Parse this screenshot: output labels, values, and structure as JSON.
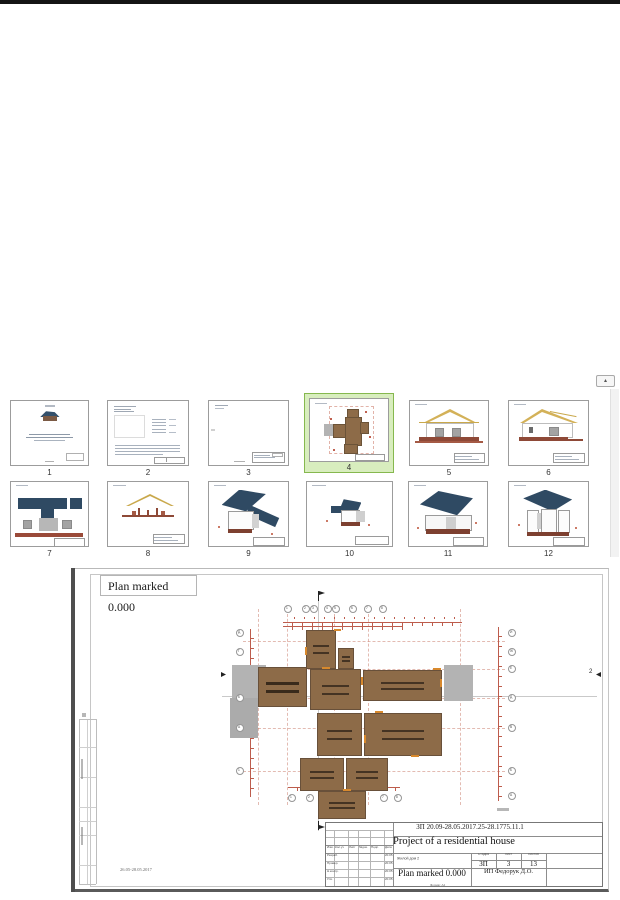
{
  "top_bar_color": "#141414",
  "thumbnails": {
    "items": [
      {
        "label": "1",
        "name": "title-page"
      },
      {
        "label": "2",
        "name": "general-notes-sheet"
      },
      {
        "label": "3",
        "name": "blank-sheet"
      },
      {
        "label": "4",
        "name": "floor-plan-sheet",
        "selected": true
      },
      {
        "label": "5",
        "name": "elevation-front"
      },
      {
        "label": "6",
        "name": "elevation-rear"
      },
      {
        "label": "7",
        "name": "elevation-side"
      },
      {
        "label": "8",
        "name": "section"
      },
      {
        "label": "9",
        "name": "3d-view-1"
      },
      {
        "label": "10",
        "name": "3d-view-2"
      },
      {
        "label": "11",
        "name": "3d-view-3"
      },
      {
        "label": "12",
        "name": "3d-view-4"
      }
    ],
    "selected_bg": "#d8edbe",
    "selected_border": "#86b84e"
  },
  "scrollbar": {
    "up_glyph": "▴"
  },
  "preview": {
    "plan_label": "Plan marked 0.000",
    "sheet_note": "26.05-28.05.2017",
    "section_marker": "2",
    "axes_top": [
      "1",
      "2",
      "3",
      "4",
      "5",
      "6",
      "7",
      "8"
    ],
    "axes_left": [
      "Д",
      "Г",
      "Б",
      "А",
      "1"
    ],
    "axes_right": [
      "И",
      "Ж",
      "Е",
      "Д",
      "В",
      "Б",
      "А"
    ],
    "axes_bottom": [
      "1",
      "2",
      "7",
      "8"
    ],
    "title_block": {
      "code": "ЗП 20.09-28.05.2017.25-28.1775.11.1",
      "project_title": "Project of a residential house",
      "object_name": "Жилой дом 2",
      "stage_label": "Стадия",
      "sheet_label": "Лист",
      "sheets_label": "Листов",
      "stage": "ЗП",
      "sheet": "3",
      "sheets": "13",
      "drawing_title": "Plan marked 0.000",
      "author": "ИП Федорук Д.О.",
      "columns": [
        "Изм.",
        "Кол.уч",
        "Лист",
        "№док.",
        "Подп.",
        "Дата"
      ],
      "rows": [
        {
          "label": "Разраб.",
          "date": "20.05"
        },
        {
          "label": "Провер.",
          "date": "20.05"
        },
        {
          "label": "Н.контр.",
          "date": "20.05"
        },
        {
          "label": "Утв.",
          "date": "20.05"
        }
      ],
      "format_note": "Формат А4"
    }
  }
}
